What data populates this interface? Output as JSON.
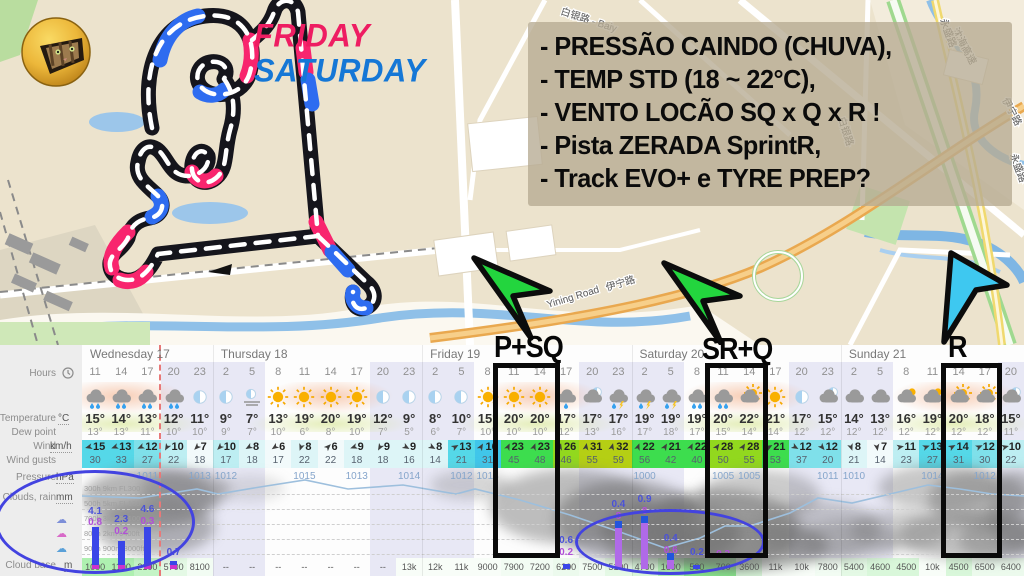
{
  "map": {
    "friday_label": "FRIDAY",
    "saturday_label": "SATURDAY",
    "friday_color": "#EE1D62",
    "saturday_color": "#1577D6",
    "notes": [
      "- PRESSÃO CAINDO (CHUVA),",
      "- TEMP STD (18 ~ 22°C),",
      "- VENTO LOCÃO SQ x Q x R !",
      "- Pista ZERADA SprintR,",
      "- Track EVO+ e TYRE PREP?"
    ],
    "road_labels": [
      {
        "text": "白银路 - Baiy",
        "x": 560,
        "y": 14,
        "rot": 18
      },
      {
        "text": "白银路",
        "x": 838,
        "y": 118,
        "rot": 72
      },
      {
        "text": "沈海高速",
        "x": 952,
        "y": 30,
        "rot": 62
      },
      {
        "text": "伊宁路",
        "x": 607,
        "y": 291,
        "rot": -17
      },
      {
        "text": "Yining Road",
        "x": 548,
        "y": 308,
        "rot": -17
      },
      {
        "text": "伊宁路",
        "x": 1002,
        "y": 100,
        "rot": 62
      },
      {
        "text": "永盛路",
        "x": 940,
        "y": 20,
        "rot": 70
      },
      {
        "text": "永盛路",
        "x": 1010,
        "y": 155,
        "rot": 70
      }
    ]
  },
  "annotations": {
    "sessions": [
      {
        "label": "P+SQ",
        "text_x": 494,
        "text_y": 332,
        "box_x": 493,
        "box_w": 67
      },
      {
        "label": "SR+Q",
        "text_x": 702,
        "text_y": 334,
        "box_x": 705,
        "box_w": 63
      },
      {
        "label": "R",
        "text_x": 948,
        "text_y": 332,
        "box_x": 941,
        "box_w": 61
      }
    ]
  },
  "forecast": {
    "row_labels": {
      "hours": "Hours",
      "temperature": "Temperature",
      "dew_point": "Dew point",
      "wind": "Wind",
      "wind_gusts": "Wind gusts",
      "pressure": "Pressure",
      "clouds_rain": "Clouds, rain",
      "cloud_base": "Cloud base"
    },
    "units": {
      "temperature": "°C",
      "wind": "km/h",
      "pressure": "hPa",
      "clouds_rain": "mm",
      "cloud_base": "m"
    },
    "days": [
      {
        "label": "Wednesday 17",
        "cols": 5
      },
      {
        "label": "Thursday 18",
        "cols": 8
      },
      {
        "label": "Friday 19",
        "cols": 8
      },
      {
        "label": "Saturday 20",
        "cols": 8
      },
      {
        "label": "Sunday 21",
        "cols": 7
      }
    ],
    "hours": [
      11,
      14,
      17,
      20,
      23,
      2,
      5,
      8,
      11,
      14,
      17,
      20,
      23,
      2,
      5,
      8,
      11,
      14,
      17,
      20,
      23,
      2,
      5,
      8,
      11,
      14,
      17,
      20,
      23,
      2,
      5,
      8,
      11,
      14,
      17,
      20
    ],
    "icons": [
      "rain",
      "rain",
      "rain",
      "rain",
      "moon",
      "moon",
      "fog",
      "sun",
      "sun",
      "sun",
      "sun",
      "moon",
      "moon",
      "moon",
      "moon",
      "sun",
      "sun",
      "sun",
      "rain-light",
      "moon-cloud",
      "storm",
      "storm",
      "storm",
      "rain",
      "rain",
      "sun-cloud",
      "sun",
      "moon",
      "moon-cloud",
      "cloud",
      "cloud",
      "cloud-sun",
      "cloud-sun",
      "sun-cloud",
      "sun-cloud",
      "moon-cloud"
    ],
    "temperature": [
      15,
      14,
      13,
      12,
      11,
      9,
      7,
      13,
      19,
      20,
      19,
      12,
      9,
      8,
      10,
      15,
      20,
      20,
      17,
      17,
      17,
      19,
      19,
      19,
      20,
      22,
      21,
      17,
      15,
      14,
      13,
      16,
      19,
      20,
      18,
      15
    ],
    "dew_point": [
      13,
      13,
      11,
      10,
      10,
      9,
      7,
      10,
      6,
      8,
      10,
      7,
      5,
      6,
      7,
      10,
      10,
      10,
      12,
      13,
      16,
      17,
      18,
      17,
      15,
      14,
      14,
      12,
      12,
      12,
      12,
      12,
      12,
      12,
      12,
      11
    ],
    "wind": [
      15,
      13,
      12,
      10,
      7,
      10,
      8,
      6,
      8,
      6,
      9,
      9,
      9,
      8,
      13,
      16,
      23,
      23,
      26,
      31,
      32,
      22,
      21,
      22,
      28,
      28,
      21,
      12,
      12,
      8,
      7,
      11,
      13,
      14,
      12,
      10
    ],
    "wind_gusts": [
      30,
      33,
      27,
      22,
      18,
      17,
      18,
      17,
      22,
      22,
      18,
      18,
      16,
      14,
      21,
      31,
      45,
      48,
      46,
      55,
      59,
      56,
      42,
      40,
      50,
      55,
      53,
      37,
      20,
      21,
      14,
      23,
      27,
      31,
      30,
      22
    ],
    "wind_dir_deg": [
      255,
      250,
      245,
      210,
      225,
      225,
      240,
      235,
      200,
      45,
      250,
      210,
      120,
      120,
      60,
      30,
      25,
      20,
      15,
      10,
      15,
      20,
      30,
      25,
      35,
      30,
      60,
      120,
      140,
      160,
      170,
      80,
      70,
      60,
      65,
      75
    ],
    "cloud_base": [
      "1000",
      "1100",
      "2100",
      "5700",
      "8100",
      "--",
      "--",
      "--",
      "--",
      "--",
      "--",
      "--",
      "13k",
      "12k",
      "11k",
      "9000",
      "7900",
      "7200",
      "6200",
      "7500",
      "5100",
      "4700",
      "1600",
      "500",
      "700",
      "3600",
      "11k",
      "10k",
      "7800",
      "5400",
      "4600",
      "4500",
      "10k",
      "4500",
      "6500",
      "6400"
    ],
    "pressure_labels": [
      {
        "c": 2,
        "v": "1011"
      },
      {
        "c": 4,
        "v": "1013"
      },
      {
        "c": 5,
        "v": "1012"
      },
      {
        "c": 8,
        "v": "1015"
      },
      {
        "c": 10,
        "v": "1013"
      },
      {
        "c": 12,
        "v": "1014"
      },
      {
        "c": 14,
        "v": "1012"
      },
      {
        "c": 15,
        "v": "1013"
      },
      {
        "c": 21,
        "v": "1000"
      },
      {
        "c": 24,
        "v": "1005"
      },
      {
        "c": 25,
        "v": "1005"
      },
      {
        "c": 28,
        "v": "1011"
      },
      {
        "c": 29,
        "v": "1010"
      },
      {
        "c": 32,
        "v": "1014"
      },
      {
        "c": 34,
        "v": "1012"
      }
    ],
    "rain_labels": [
      {
        "c": 0,
        "top": "4.1",
        "bot": "0.8",
        "ty": 161,
        "by": 172
      },
      {
        "c": 1,
        "top": "2.3",
        "bot": "0.2",
        "ty": 169,
        "by": 181
      },
      {
        "c": 2,
        "top": "4.6",
        "bot": "0.3",
        "ty": 159,
        "by": 171
      },
      {
        "c": 3,
        "top": "0.7",
        "ty": 202
      },
      {
        "c": 18,
        "top": "0.6",
        "bot": "0.2",
        "ty": 190,
        "by": 202
      },
      {
        "c": 20,
        "top": "0.4",
        "bot": "8",
        "ty": 154,
        "by": 166
      },
      {
        "c": 21,
        "top": "0.9",
        "bot": "8",
        "ty": 149,
        "by": 161
      },
      {
        "c": 22,
        "top": "0.4",
        "bot": "0.6",
        "ty": 188,
        "by": 200
      },
      {
        "c": 23,
        "top": "0.2",
        "ty": 202
      },
      {
        "c": 24,
        "bot": "0.2",
        "by": 204
      }
    ],
    "rain_bars": [
      {
        "c": 0,
        "h": 42,
        "style": "blue"
      },
      {
        "c": 1,
        "h": 28,
        "style": "blue"
      },
      {
        "c": 2,
        "h": 42,
        "style": "blue"
      },
      {
        "c": 3,
        "h": 8,
        "style": "blue"
      },
      {
        "c": 18,
        "h": 5,
        "style": "blue"
      },
      {
        "c": 20,
        "h": 48,
        "style": "purple"
      },
      {
        "c": 21,
        "h": 53,
        "style": "purple"
      },
      {
        "c": 22,
        "h": 16,
        "style": "purple"
      },
      {
        "c": 23,
        "h": 4,
        "style": "blue"
      }
    ],
    "altitude_labels": [
      "300h 9km FL300",
      "500h 5km FL180",
      "700h 3km FL100",
      "800h 2km 6400ft",
      "900h 900m 3000ft"
    ]
  }
}
